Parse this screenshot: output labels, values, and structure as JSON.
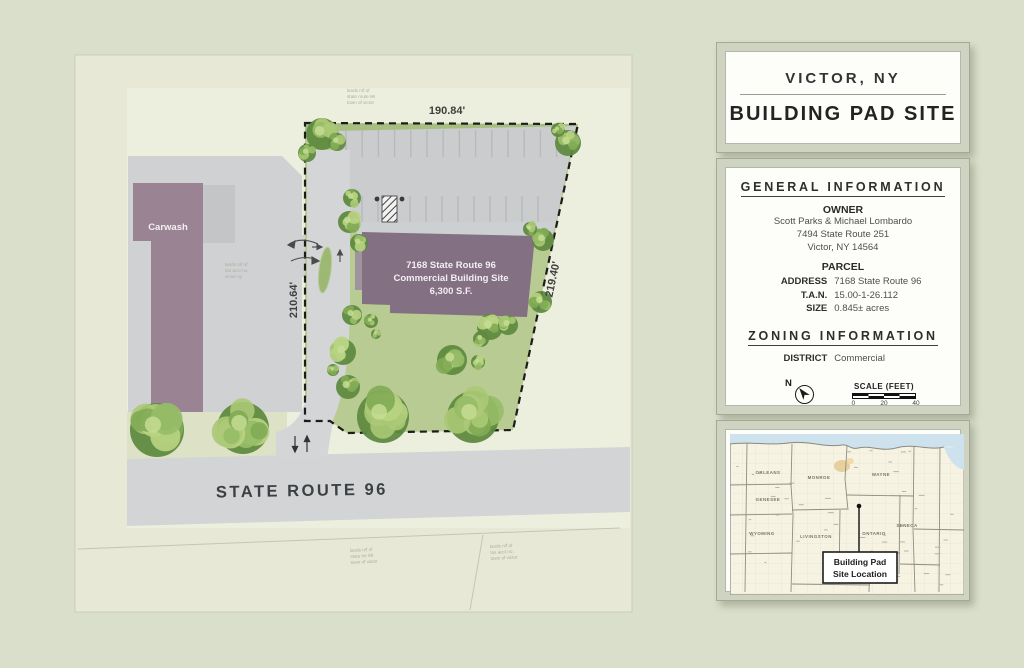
{
  "header": {
    "city": "VICTOR, NY",
    "title": "BUILDING PAD SITE"
  },
  "general_info": {
    "heading": "GENERAL INFORMATION",
    "owner_heading": "OWNER",
    "owner_lines": [
      "Scott Parks & Michael Lombardo",
      "7494 State Route 251",
      "Victor, NY 14564"
    ],
    "parcel_heading": "PARCEL",
    "parcel_rows": [
      {
        "label": "ADDRESS",
        "value": "7168 State Route 96"
      },
      {
        "label": "T.A.N.",
        "value": "15.00-1-26.112"
      },
      {
        "label": "SIZE",
        "value": "0.845± acres"
      }
    ]
  },
  "zoning_info": {
    "heading": "ZONING INFORMATION",
    "district_label": "DISTRICT",
    "district_value": "Commercial"
  },
  "compass": {
    "north_label": "N"
  },
  "scale_bar": {
    "title": "SCALE (FEET)",
    "ticks": [
      "0",
      "20",
      "40"
    ]
  },
  "site_plan": {
    "dim_top": "190.84'",
    "dim_left": "210.64'",
    "dim_right": "219.40'",
    "carwash_label": "Carwash",
    "building_lines": [
      "7168 State Route 96",
      "Commercial Building Site",
      "6,300 S.F."
    ],
    "road_label": "STATE ROUTE 96",
    "illegible_annotations": [
      [
        "lands n/f of",
        "state route 96",
        "town of victor"
      ],
      [
        "lands n/f of",
        "tax acct no.",
        "victor ny"
      ],
      [
        "lands n/f of",
        "state rte 96",
        "town of victor"
      ],
      [
        "lands n/f of",
        "tax acct no.",
        "town of victor"
      ]
    ]
  },
  "location_map": {
    "counties": [
      "ORLEANS",
      "GENESEE",
      "WYOMING",
      "MONROE",
      "LIVINGSTON",
      "WAYNE",
      "ONTARIO",
      "SENECA"
    ],
    "callout_lines": [
      "Building Pad",
      "Site Location"
    ]
  },
  "colors": {
    "background": "#d9dfca",
    "paper": "#e7e9d6",
    "lawn": "#b8cb92",
    "pavement": "#cfd1d3",
    "building_purple": "#837082",
    "carwash_purple": "#9a8494",
    "lake_blue": "#cde2ed",
    "boundary": "#1c1c1c"
  }
}
